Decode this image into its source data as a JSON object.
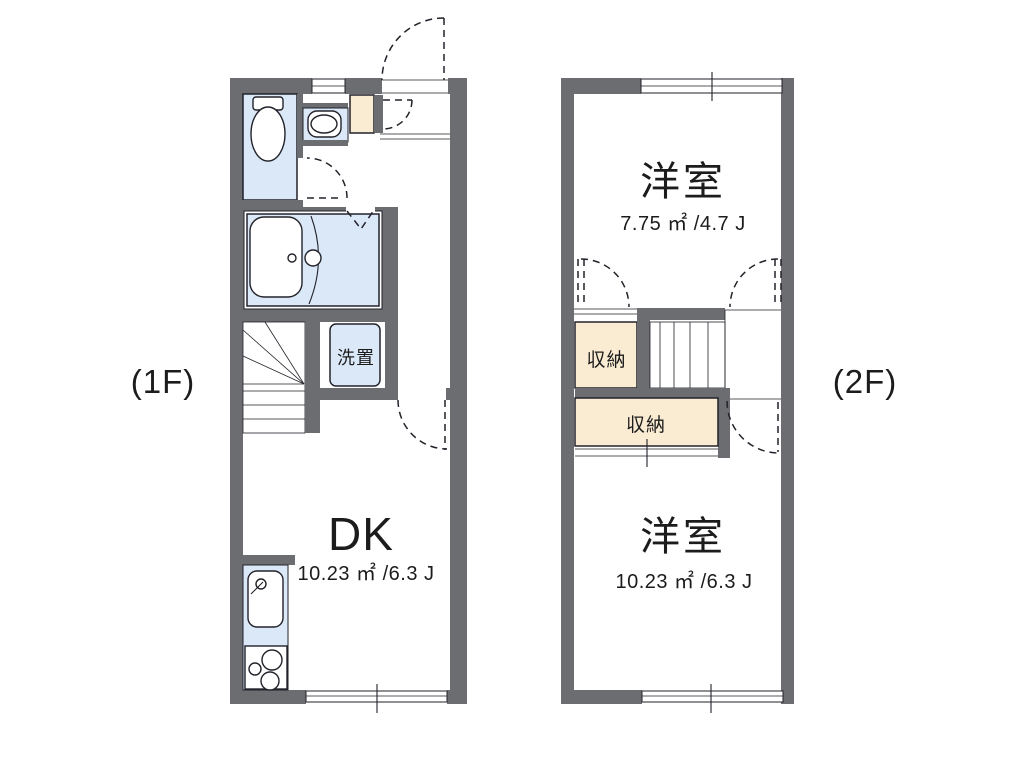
{
  "colors": {
    "wall": "#6b6d71",
    "ink": "#1c1c1c",
    "line": "#22222a",
    "fixture": "#dbe8f8",
    "storage": "#faecd2",
    "paper": "#ffffff"
  },
  "floors": [
    {
      "floor_label": "(1F)",
      "rooms": [
        {
          "id": "dining-kitchen",
          "label": "DK",
          "area_label": "10.23 ㎡ /6.3 J"
        },
        {
          "id": "washer-space",
          "label": "洗置"
        }
      ],
      "fixtures": [
        "toilet",
        "washbasin",
        "water-heater",
        "unit-bath",
        "bathtub",
        "shower-door",
        "winder-staircase",
        "kitchen-sink",
        "gas-stove",
        "entrance-door-swing",
        "room-door-swings",
        "windows"
      ]
    },
    {
      "floor_label": "(2F)",
      "rooms": [
        {
          "id": "bedroom-upper",
          "label": "洋室",
          "area_label": "7.75 ㎡ /4.7 J"
        },
        {
          "id": "closet-upper",
          "label": "収納"
        },
        {
          "id": "closet-lower",
          "label": "収納"
        },
        {
          "id": "bedroom-lower",
          "label": "洋室",
          "area_label": "10.23 ㎡ /6.3 J"
        }
      ],
      "fixtures": [
        "staircase",
        "closet-door-swings",
        "room-door-swing",
        "sliding-closet-front",
        "windows"
      ]
    }
  ]
}
